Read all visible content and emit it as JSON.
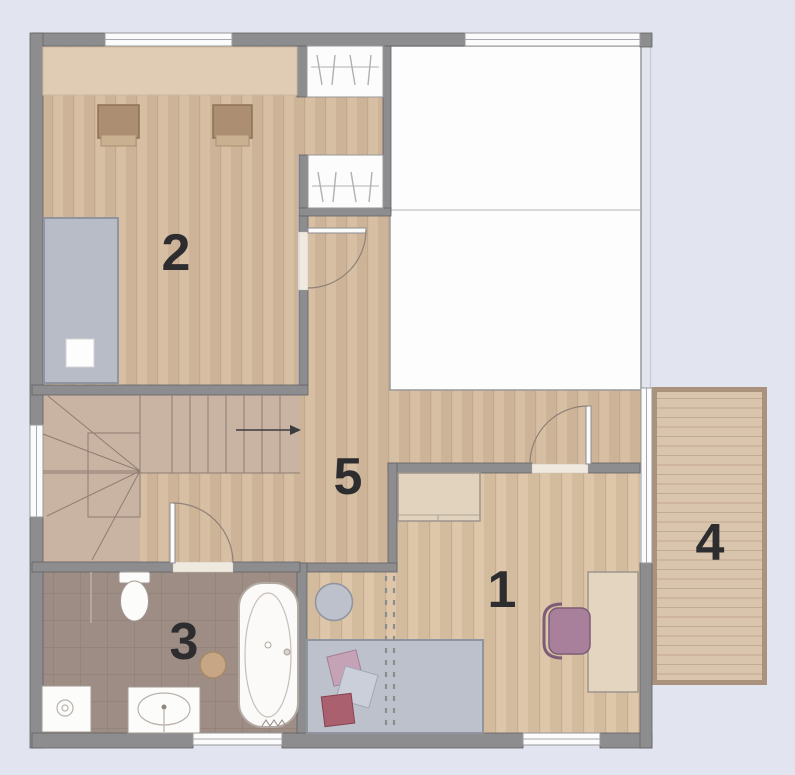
{
  "plan": {
    "type": "floor-plan",
    "background_color": "#e2e4f0",
    "rooms": [
      {
        "number": "1"
      },
      {
        "number": "2"
      },
      {
        "number": "3"
      },
      {
        "number": "4"
      },
      {
        "number": "5"
      }
    ],
    "icons": {
      "stairs_direction_arrow": "right-arrow",
      "clothes_hanger": "diagonal-strokes-on-rail",
      "bathtub": "oval-in-rounded-rect",
      "toilet": "tank-and-bowl",
      "sink": "oval-basin-with-faucet",
      "washing_machine": "square-with-porthole"
    },
    "palette": {
      "wall": "#8d8d8f",
      "wood_floor": "#d7bfa4",
      "bedroom_floor": "#ddc6aa",
      "stair_floor": "#c9b3a3",
      "bathroom_tile": "#9d8d85",
      "balcony_deck": "#d9c4ad",
      "balcony_border": "#ab927d",
      "furniture_tan": "#e1d3bd",
      "stool_brown": "#ac8e72",
      "bed_gray": "#bdc1cb",
      "chair_mauve": "#a8809c",
      "pillow_rose": "#aa606e",
      "pillow_pink": "#c6a2b6",
      "label_color": "#2d2d30"
    }
  }
}
